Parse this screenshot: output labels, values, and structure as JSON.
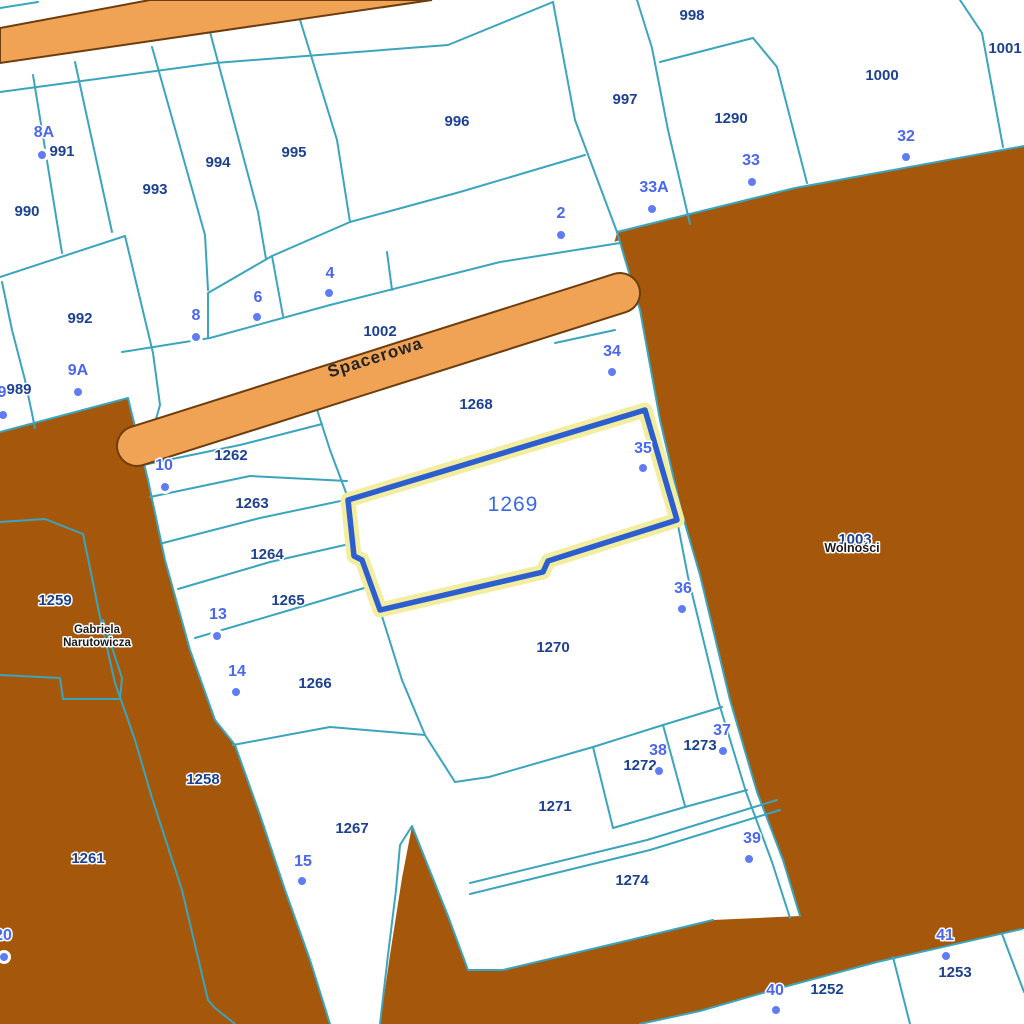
{
  "map": {
    "streets": {
      "spacerowa": "Spacerowa",
      "narutowicza_line1": "Gabriela",
      "narutowicza_line2": "Narutowicza",
      "wolnosci": "Wolności"
    },
    "selected_parcel": {
      "number": "1269"
    },
    "parcels": [
      {
        "number": "991",
        "x": 62,
        "y": 156
      },
      {
        "number": "990",
        "x": 27,
        "y": 216
      },
      {
        "number": "993",
        "x": 155,
        "y": 194
      },
      {
        "number": "994",
        "x": 218,
        "y": 167
      },
      {
        "number": "995",
        "x": 294,
        "y": 157
      },
      {
        "number": "996",
        "x": 457,
        "y": 126
      },
      {
        "number": "997",
        "x": 625,
        "y": 104
      },
      {
        "number": "998",
        "x": 692,
        "y": 20
      },
      {
        "number": "1290",
        "x": 731,
        "y": 123
      },
      {
        "number": "1000",
        "x": 882,
        "y": 80
      },
      {
        "number": "1001",
        "x": 1005,
        "y": 53
      },
      {
        "number": "992",
        "x": 80,
        "y": 323
      },
      {
        "number": "989",
        "x": 19,
        "y": 394
      },
      {
        "number": "1002",
        "x": 380,
        "y": 336
      },
      {
        "number": "1262",
        "x": 231,
        "y": 460
      },
      {
        "number": "1263",
        "x": 252,
        "y": 508
      },
      {
        "number": "1264",
        "x": 267,
        "y": 559
      },
      {
        "number": "1265",
        "x": 288,
        "y": 605
      },
      {
        "number": "1266",
        "x": 315,
        "y": 688
      },
      {
        "number": "1267",
        "x": 352,
        "y": 833
      },
      {
        "number": "1268",
        "x": 476,
        "y": 409
      },
      {
        "number": "1258",
        "x": 203,
        "y": 784
      },
      {
        "number": "1259",
        "x": 55,
        "y": 605
      },
      {
        "number": "1261",
        "x": 88,
        "y": 863
      },
      {
        "number": "1270",
        "x": 553,
        "y": 652
      },
      {
        "number": "1271",
        "x": 555,
        "y": 811
      },
      {
        "number": "1272",
        "x": 640,
        "y": 770
      },
      {
        "number": "1273",
        "x": 700,
        "y": 750
      },
      {
        "number": "1274",
        "x": 632,
        "y": 885
      },
      {
        "number": "1252",
        "x": 827,
        "y": 994
      },
      {
        "number": "1253",
        "x": 955,
        "y": 977
      },
      {
        "number": "1003",
        "x": 855,
        "y": 544
      }
    ],
    "addresses": [
      {
        "number": "8A",
        "x": 44,
        "y": 137,
        "dot_x": 42,
        "dot_y": 155
      },
      {
        "number": "9",
        "x": 2,
        "y": 397,
        "dot_x": 3,
        "dot_y": 415
      },
      {
        "number": "9A",
        "x": 78,
        "y": 375,
        "dot_x": 78,
        "dot_y": 392
      },
      {
        "number": "8",
        "x": 196,
        "y": 320,
        "dot_x": 196,
        "dot_y": 337
      },
      {
        "number": "6",
        "x": 258,
        "y": 302,
        "dot_x": 257,
        "dot_y": 317
      },
      {
        "number": "4",
        "x": 330,
        "y": 278,
        "dot_x": 329,
        "dot_y": 293
      },
      {
        "number": "2",
        "x": 561,
        "y": 218,
        "dot_x": 561,
        "dot_y": 235
      },
      {
        "number": "33A",
        "x": 654,
        "y": 192,
        "dot_x": 652,
        "dot_y": 209
      },
      {
        "number": "33",
        "x": 751,
        "y": 165,
        "dot_x": 752,
        "dot_y": 182
      },
      {
        "number": "32",
        "x": 906,
        "y": 141,
        "dot_x": 906,
        "dot_y": 157
      },
      {
        "number": "10",
        "x": 164,
        "y": 470,
        "dot_x": 165,
        "dot_y": 487
      },
      {
        "number": "13",
        "x": 218,
        "y": 619,
        "dot_x": 217,
        "dot_y": 636
      },
      {
        "number": "14",
        "x": 237,
        "y": 676,
        "dot_x": 236,
        "dot_y": 692
      },
      {
        "number": "15",
        "x": 303,
        "y": 866,
        "dot_x": 302,
        "dot_y": 881
      },
      {
        "number": "34",
        "x": 612,
        "y": 356,
        "dot_x": 612,
        "dot_y": 372
      },
      {
        "number": "35",
        "x": 643,
        "y": 453,
        "dot_x": 643,
        "dot_y": 468
      },
      {
        "number": "36",
        "x": 683,
        "y": 593,
        "dot_x": 682,
        "dot_y": 609
      },
      {
        "number": "37",
        "x": 722,
        "y": 735,
        "dot_x": 723,
        "dot_y": 751
      },
      {
        "number": "38",
        "x": 658,
        "y": 755,
        "dot_x": 659,
        "dot_y": 771
      },
      {
        "number": "39",
        "x": 752,
        "y": 843,
        "dot_x": 749,
        "dot_y": 859
      },
      {
        "number": "40",
        "x": 775,
        "y": 995,
        "dot_x": 776,
        "dot_y": 1010
      },
      {
        "number": "41",
        "x": 945,
        "y": 940,
        "dot_x": 946,
        "dot_y": 956
      },
      {
        "number": "20",
        "x": 3,
        "y": 940,
        "dot_x": 4,
        "dot_y": 957
      }
    ],
    "colors": {
      "parcel_line": "#3aa5bd",
      "parcel_number": "#1d4191",
      "address_number": "#4b67ee",
      "address_dot": "#5f7cf5",
      "land_brown": "#a5570b",
      "road_fill": "#f1a355",
      "road_border": "#6e3d0e",
      "selected_stroke": "#2d5ecf",
      "selected_halo": "#f3eda0",
      "selected_label": "#3b68e5",
      "street_text": "#1b1b1b",
      "background": "#ffffff"
    }
  }
}
